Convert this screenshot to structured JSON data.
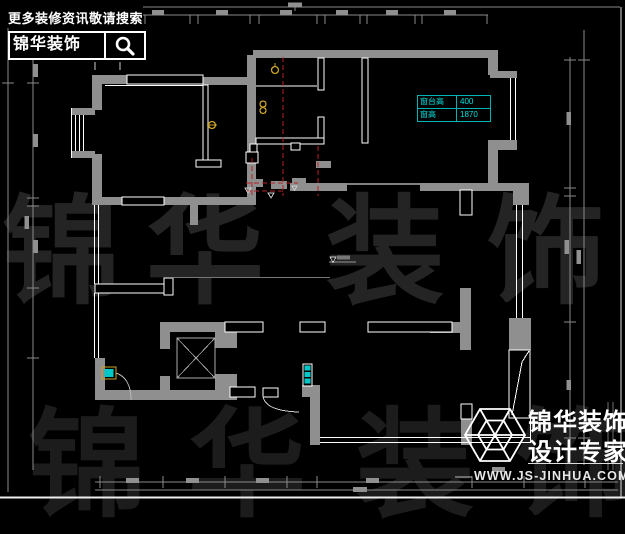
{
  "badge": {
    "tagline": "更多装修资讯敬请搜索",
    "brand": "锦华装饰"
  },
  "window_table": {
    "rows": [
      {
        "label": "窗台高",
        "value": "400"
      },
      {
        "label": "窗高",
        "value": "1870"
      }
    ]
  },
  "watermark": {
    "chars": [
      "锦",
      "华",
      "装",
      "饰"
    ]
  },
  "logo": {
    "brand": "锦华装饰",
    "subtitle": "设计专家",
    "url": "WWW.JS-JINHUA.COM"
  },
  "colors": {
    "wall": "#8f8f8f",
    "outline": "#ffffff",
    "hidden_line": "#b52222",
    "annotation_cyan": "#00c8c8",
    "fixture_yellow": "#c9a22a",
    "watermark": "#242424"
  }
}
